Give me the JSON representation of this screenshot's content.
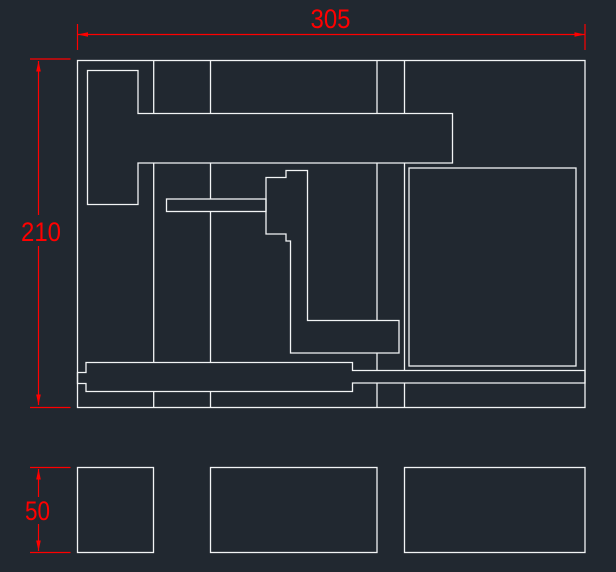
{
  "app": {
    "background": "#212830",
    "geometry_color": "#f2f4f5",
    "dimension_color": "#ff0000"
  },
  "drawing": {
    "canvas_width": 616,
    "canvas_height": 572,
    "views": {
      "top_view": "plate with slots and pockets",
      "front_view": "three section blocks"
    },
    "shapes": [
      {
        "name": "plate-outline",
        "type": "rect",
        "x": 77.5,
        "y": 60.5,
        "w": 507.5,
        "h": 347
      },
      {
        "name": "tee-cutout",
        "type": "polygon",
        "pts": "87.5,70.5 138,70.5 138,113.5 452.5,113.5 452.5,163 138,163 138,204.5 87.5,204.5"
      },
      {
        "name": "spear-slot",
        "type": "rect",
        "x": 166.5,
        "y": 199,
        "w": 99.5,
        "h": 12.5
      },
      {
        "name": "step-cutout",
        "type": "polygon",
        "pts": "266,177.5 286,177.5 286,170.5 307.5,170.5 307.5,320.5 399,320.5 399,353 290.5,353 290.5,241 286,241 286,234 266,234"
      },
      {
        "name": "square-pocket",
        "type": "rect",
        "x": 409,
        "y": 168,
        "w": 167,
        "h": 198
      },
      {
        "name": "bottom-rail",
        "type": "polygon",
        "pts": "86,362.5 352.5,362.5 352.5,370.5 585,370.5 585,383 352.5,383 352.5,391.5 86,391.5 86,383.5 77.5,383.5 77.5,372.5 86,372.5"
      },
      {
        "name": "channel-line-1",
        "type": "vlines",
        "x": 153.7,
        "spans": [
          [
            60.5,
            113.5
          ],
          [
            163,
            362.5
          ],
          [
            391.5,
            407.5
          ]
        ]
      },
      {
        "name": "channel-line-2",
        "type": "vlines",
        "x": 210.5,
        "spans": [
          [
            60.5,
            113.5
          ],
          [
            163,
            199
          ],
          [
            211.5,
            362.5
          ],
          [
            391.5,
            407.5
          ]
        ]
      },
      {
        "name": "channel-line-3",
        "type": "vlines",
        "x": 377,
        "spans": [
          [
            60.5,
            113.5
          ],
          [
            163,
            320.5
          ],
          [
            353,
            370.5
          ],
          [
            383,
            407.5
          ]
        ]
      },
      {
        "name": "channel-line-4",
        "type": "vlines",
        "x": 404.5,
        "spans": [
          [
            60.5,
            113.5
          ],
          [
            163,
            370.5
          ],
          [
            383,
            407.5
          ]
        ]
      },
      {
        "name": "front-view-block-left",
        "type": "rect",
        "x": 77.5,
        "y": 467.5,
        "w": 76,
        "h": 85
      },
      {
        "name": "front-view-block-middle",
        "type": "rect",
        "x": 210.5,
        "y": 467.5,
        "w": 166.5,
        "h": 85
      },
      {
        "name": "front-view-block-right",
        "type": "rect",
        "x": 404.5,
        "y": 467.5,
        "w": 180.5,
        "h": 85
      }
    ],
    "dimensions": [
      {
        "name": "dim-width-305",
        "label": "305",
        "label_x": 330.5,
        "label_y": 28,
        "label_length": 40,
        "line_segments": [
          [
            77.5,
            34.5,
            585,
            34.5
          ]
        ],
        "extension_lines": [
          [
            77.5,
            24,
            77.5,
            50
          ],
          [
            585,
            24,
            585,
            50
          ]
        ],
        "arrows": [
          {
            "x": 77.5,
            "y": 34.5,
            "dir": "left"
          },
          {
            "x": 585,
            "y": 34.5,
            "dir": "right"
          }
        ]
      },
      {
        "name": "dim-height-210",
        "label": "210",
        "label_x": 41,
        "label_y": 241,
        "label_length": 40,
        "line_segments": [
          [
            38.5,
            61,
            38.5,
            215
          ],
          [
            38.5,
            246,
            38.5,
            405
          ]
        ],
        "extension_lines": [
          [
            30,
            59,
            70.5,
            59
          ],
          [
            30,
            407.5,
            70.5,
            407.5
          ]
        ],
        "arrows": [
          {
            "x": 38.5,
            "y": 61,
            "dir": "up"
          },
          {
            "x": 38.5,
            "y": 405,
            "dir": "down"
          }
        ]
      },
      {
        "name": "dim-height-50",
        "label": "50",
        "label_x": 37.5,
        "label_y": 520,
        "label_length": 25,
        "line_segments": [
          [
            38.5,
            469,
            38.5,
            497
          ],
          [
            38.5,
            524,
            38.5,
            551
          ]
        ],
        "extension_lines": [
          [
            30,
            467.5,
            70.5,
            467.5
          ],
          [
            30,
            552.5,
            70.5,
            552.5
          ]
        ],
        "arrows": [
          {
            "x": 38.5,
            "y": 469,
            "dir": "up"
          },
          {
            "x": 38.5,
            "y": 551,
            "dir": "down"
          }
        ]
      }
    ]
  }
}
